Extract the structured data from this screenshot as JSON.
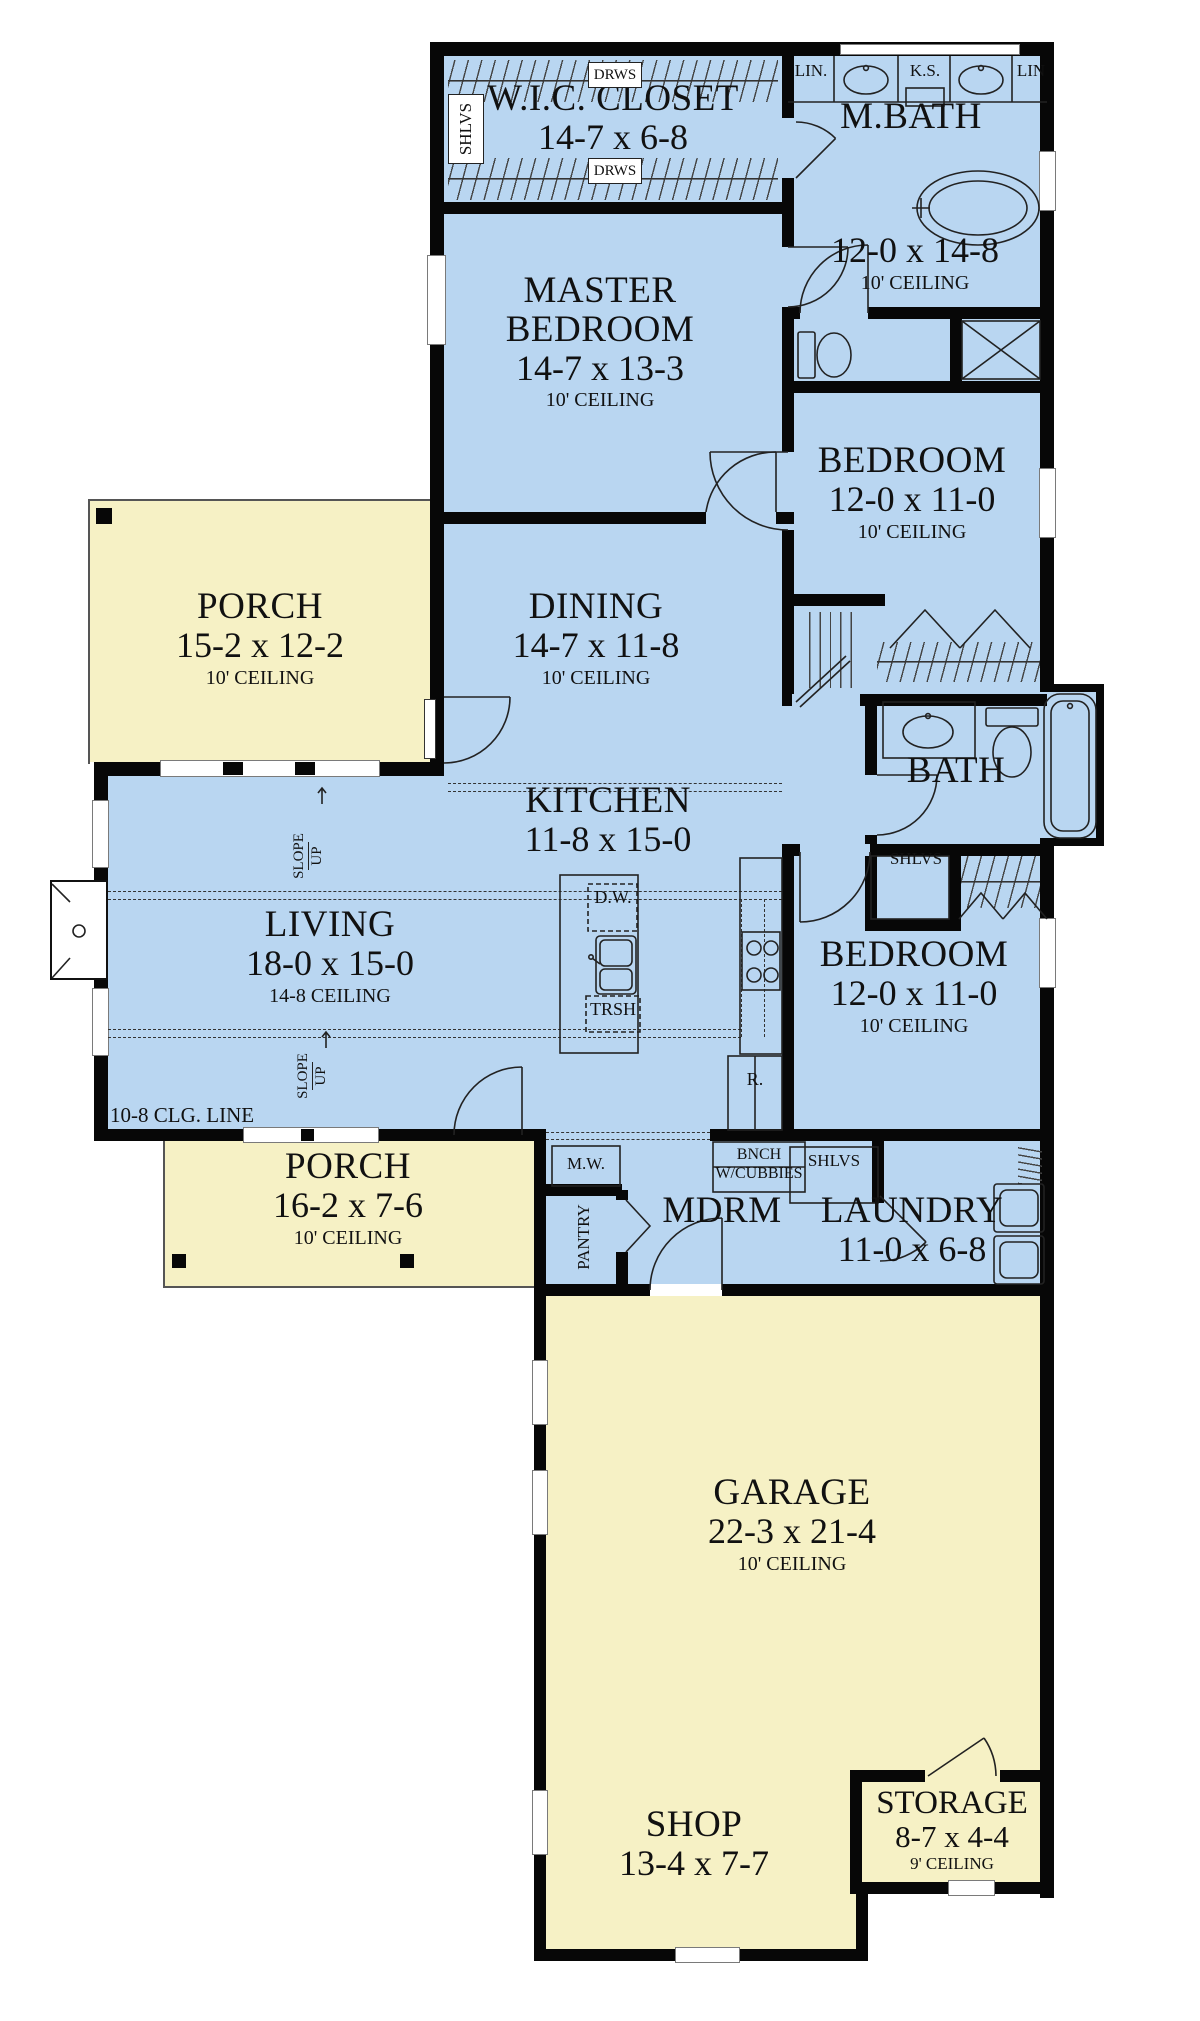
{
  "plan_title": "Single-story house floor plan",
  "colors": {
    "room_fill": "#b9d6f1",
    "porch_fill": "#f6f1c5",
    "wall": "#070707"
  },
  "rooms": {
    "wic": {
      "name": "W.I.C. CLOSET",
      "dims": "14-7 x 6-8"
    },
    "mbath": {
      "name": "M.BATH",
      "dims": "12-0 x 14-8",
      "ceil": "10' CEILING"
    },
    "master": {
      "name": "MASTER BEDROOM",
      "dims": "14-7 x 13-3",
      "ceil": "10' CEILING"
    },
    "bed1": {
      "name": "BEDROOM",
      "dims": "12-0 x 11-0",
      "ceil": "10' CEILING"
    },
    "porch1": {
      "name": "PORCH",
      "dims": "15-2 x 12-2",
      "ceil": "10' CEILING"
    },
    "dining": {
      "name": "DINING",
      "dims": "14-7 x 11-8",
      "ceil": "10' CEILING"
    },
    "kitchen": {
      "name": "KITCHEN",
      "dims": "11-8 x 15-0"
    },
    "living": {
      "name": "LIVING",
      "dims": "18-0 x 15-0",
      "ceil": "14-8 CEILING"
    },
    "bath": {
      "name": "BATH"
    },
    "bed2": {
      "name": "BEDROOM",
      "dims": "12-0 x 11-0",
      "ceil": "10' CEILING"
    },
    "porch2": {
      "name": "PORCH",
      "dims": "16-2 x 7-6",
      "ceil": "10' CEILING"
    },
    "mdrm": {
      "name": "MDRM"
    },
    "laundry": {
      "name": "LAUNDRY",
      "dims": "11-0 x 6-8"
    },
    "garage": {
      "name": "GARAGE",
      "dims": "22-3 x 21-4",
      "ceil": "10' CEILING"
    },
    "shop": {
      "name": "SHOP",
      "dims": "13-4 x 7-7"
    },
    "storage": {
      "name": "STORAGE",
      "dims": "8-7 x 4-4",
      "ceil": "9' CEILING"
    }
  },
  "fx": {
    "drws": "DRWS",
    "shlvs": "SHLVS",
    "lin_left": "LIN.",
    "lin_right": "LIN",
    "ks": "K.S.",
    "dw": "D.W.",
    "trsh": "TRSH",
    "fridge": "R.",
    "mw": "M.W.",
    "pantry": "PANTRY",
    "bnch": "BNCH",
    "cubbies": "W/CUBBIES"
  },
  "ann": {
    "slope": "SLOPE",
    "up": "UP",
    "clg_line": "10-8 CLG. LINE"
  }
}
